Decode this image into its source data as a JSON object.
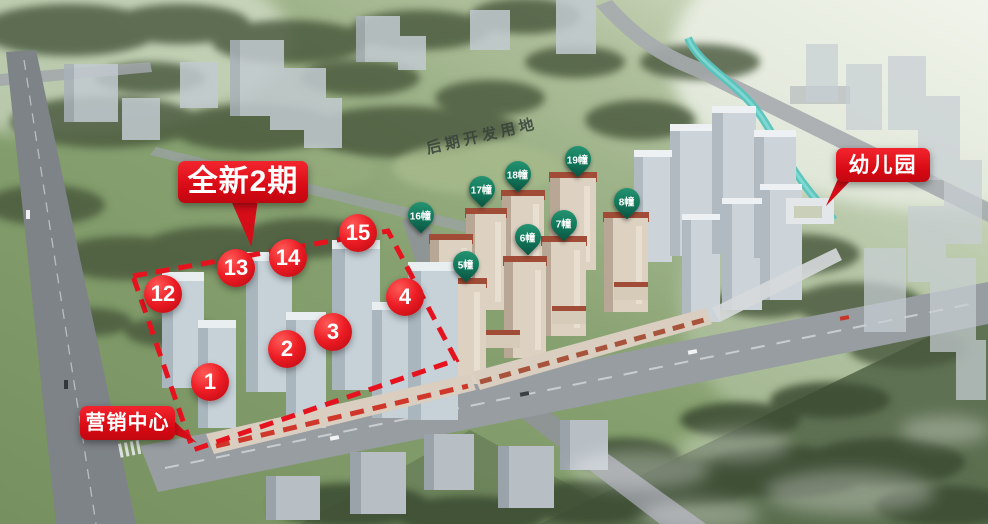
{
  "labels": {
    "phase": "全新2期",
    "future_land": "后期开发用地",
    "kindergarten": "幼儿园",
    "marketing_center": "营销中心"
  },
  "phase2_building_markers": [
    {
      "label": "1"
    },
    {
      "label": "2"
    },
    {
      "label": "3"
    },
    {
      "label": "4"
    },
    {
      "label": "12"
    },
    {
      "label": "13"
    },
    {
      "label": "14"
    },
    {
      "label": "15"
    }
  ],
  "phase1_building_pins": [
    {
      "label": "16幢"
    },
    {
      "label": "17幢"
    },
    {
      "label": "18幢"
    },
    {
      "label": "19幢"
    },
    {
      "label": "8幢"
    },
    {
      "label": "7幢"
    },
    {
      "label": "6幢"
    },
    {
      "label": "5幢"
    }
  ],
  "colors": {
    "accent_red": "#e3101c",
    "pin_green": "#137a5c"
  }
}
